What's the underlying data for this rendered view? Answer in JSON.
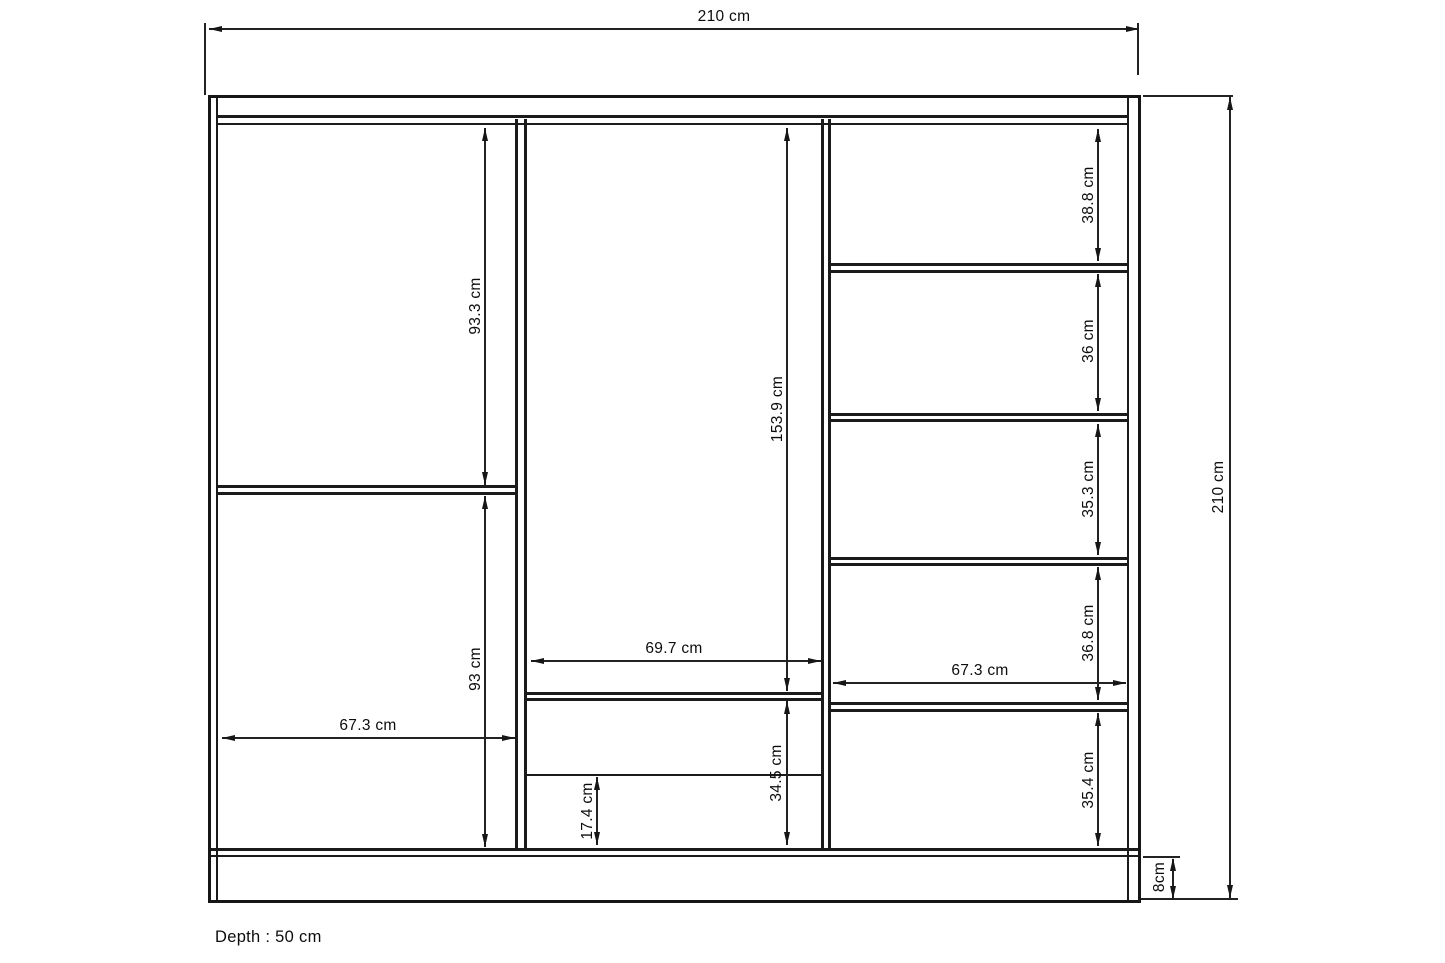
{
  "diagram": {
    "depth_note": "Depth : 50 cm",
    "overall": {
      "width": "210 cm",
      "height": "210 cm",
      "plinth_height": "8cm"
    },
    "left_column": {
      "upper_height": "93.3 cm",
      "lower_height": "93 cm",
      "width": "67.3 cm"
    },
    "middle_column": {
      "hanging_height": "153.9 cm",
      "width": "69.7 cm",
      "drawer_total_height": "34.5 cm",
      "drawer_lower_height": "17.4 cm"
    },
    "right_column": {
      "cell_1_height": "38.8 cm",
      "cell_2_height": "36 cm",
      "cell_3_height": "35.3 cm",
      "cell_4_height": "36.8 cm",
      "width": "67.3 cm",
      "cell_5_height": "35.4 cm"
    }
  }
}
